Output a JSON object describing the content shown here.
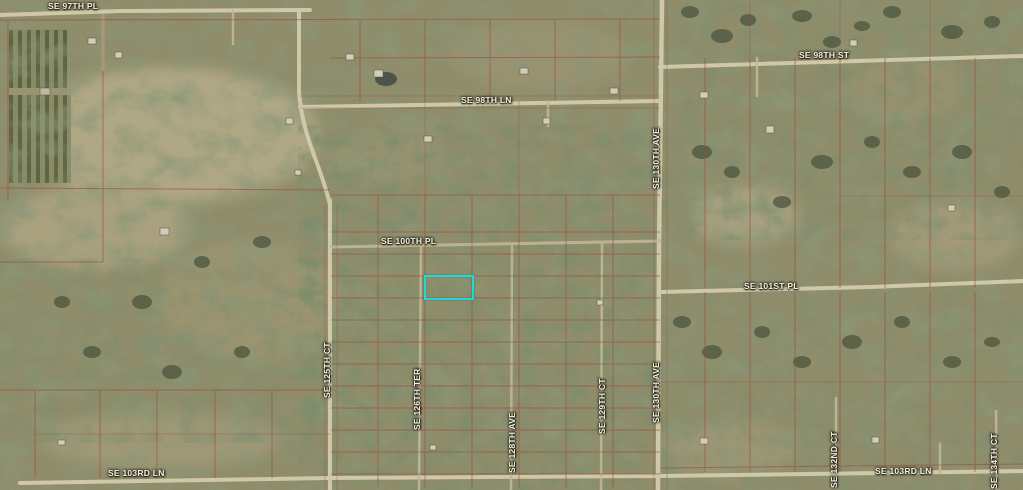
{
  "map": {
    "kind": "satellite-parcel-map",
    "street_labels": [
      {
        "text": "SE 97TH PL",
        "orientation": "horizontal"
      },
      {
        "text": "SE 98TH ST",
        "orientation": "horizontal"
      },
      {
        "text": "SE 98TH LN",
        "orientation": "horizontal"
      },
      {
        "text": "SE 100TH PL",
        "orientation": "horizontal"
      },
      {
        "text": "SE 101ST PL",
        "orientation": "horizontal"
      },
      {
        "text": "SE 103RD LN",
        "orientation": "horizontal"
      },
      {
        "text": "SE 103RD LN",
        "orientation": "horizontal"
      },
      {
        "text": "SE 125TH CT",
        "orientation": "vertical"
      },
      {
        "text": "SE 126TH TER",
        "orientation": "vertical"
      },
      {
        "text": "SE 128TH AVE",
        "orientation": "vertical"
      },
      {
        "text": "SE 129TH CT",
        "orientation": "vertical"
      },
      {
        "text": "SE 130TH AVE",
        "orientation": "vertical"
      },
      {
        "text": "SE 130TH AVE",
        "orientation": "vertical"
      },
      {
        "text": "SE 132ND CT",
        "orientation": "vertical"
      },
      {
        "text": "SE 134TH CT",
        "orientation": "vertical"
      }
    ],
    "selected_parcel": {
      "highlight_color": "#1fd8d8"
    },
    "colors": {
      "parcel_line": "#a24736",
      "road": "#ddd4b4",
      "trail": "#cbbf9d",
      "label_text": "#f4f0e2",
      "terrain_base": "#94916e",
      "forest": "#45523a",
      "clearing": "#b7ae8a"
    }
  }
}
